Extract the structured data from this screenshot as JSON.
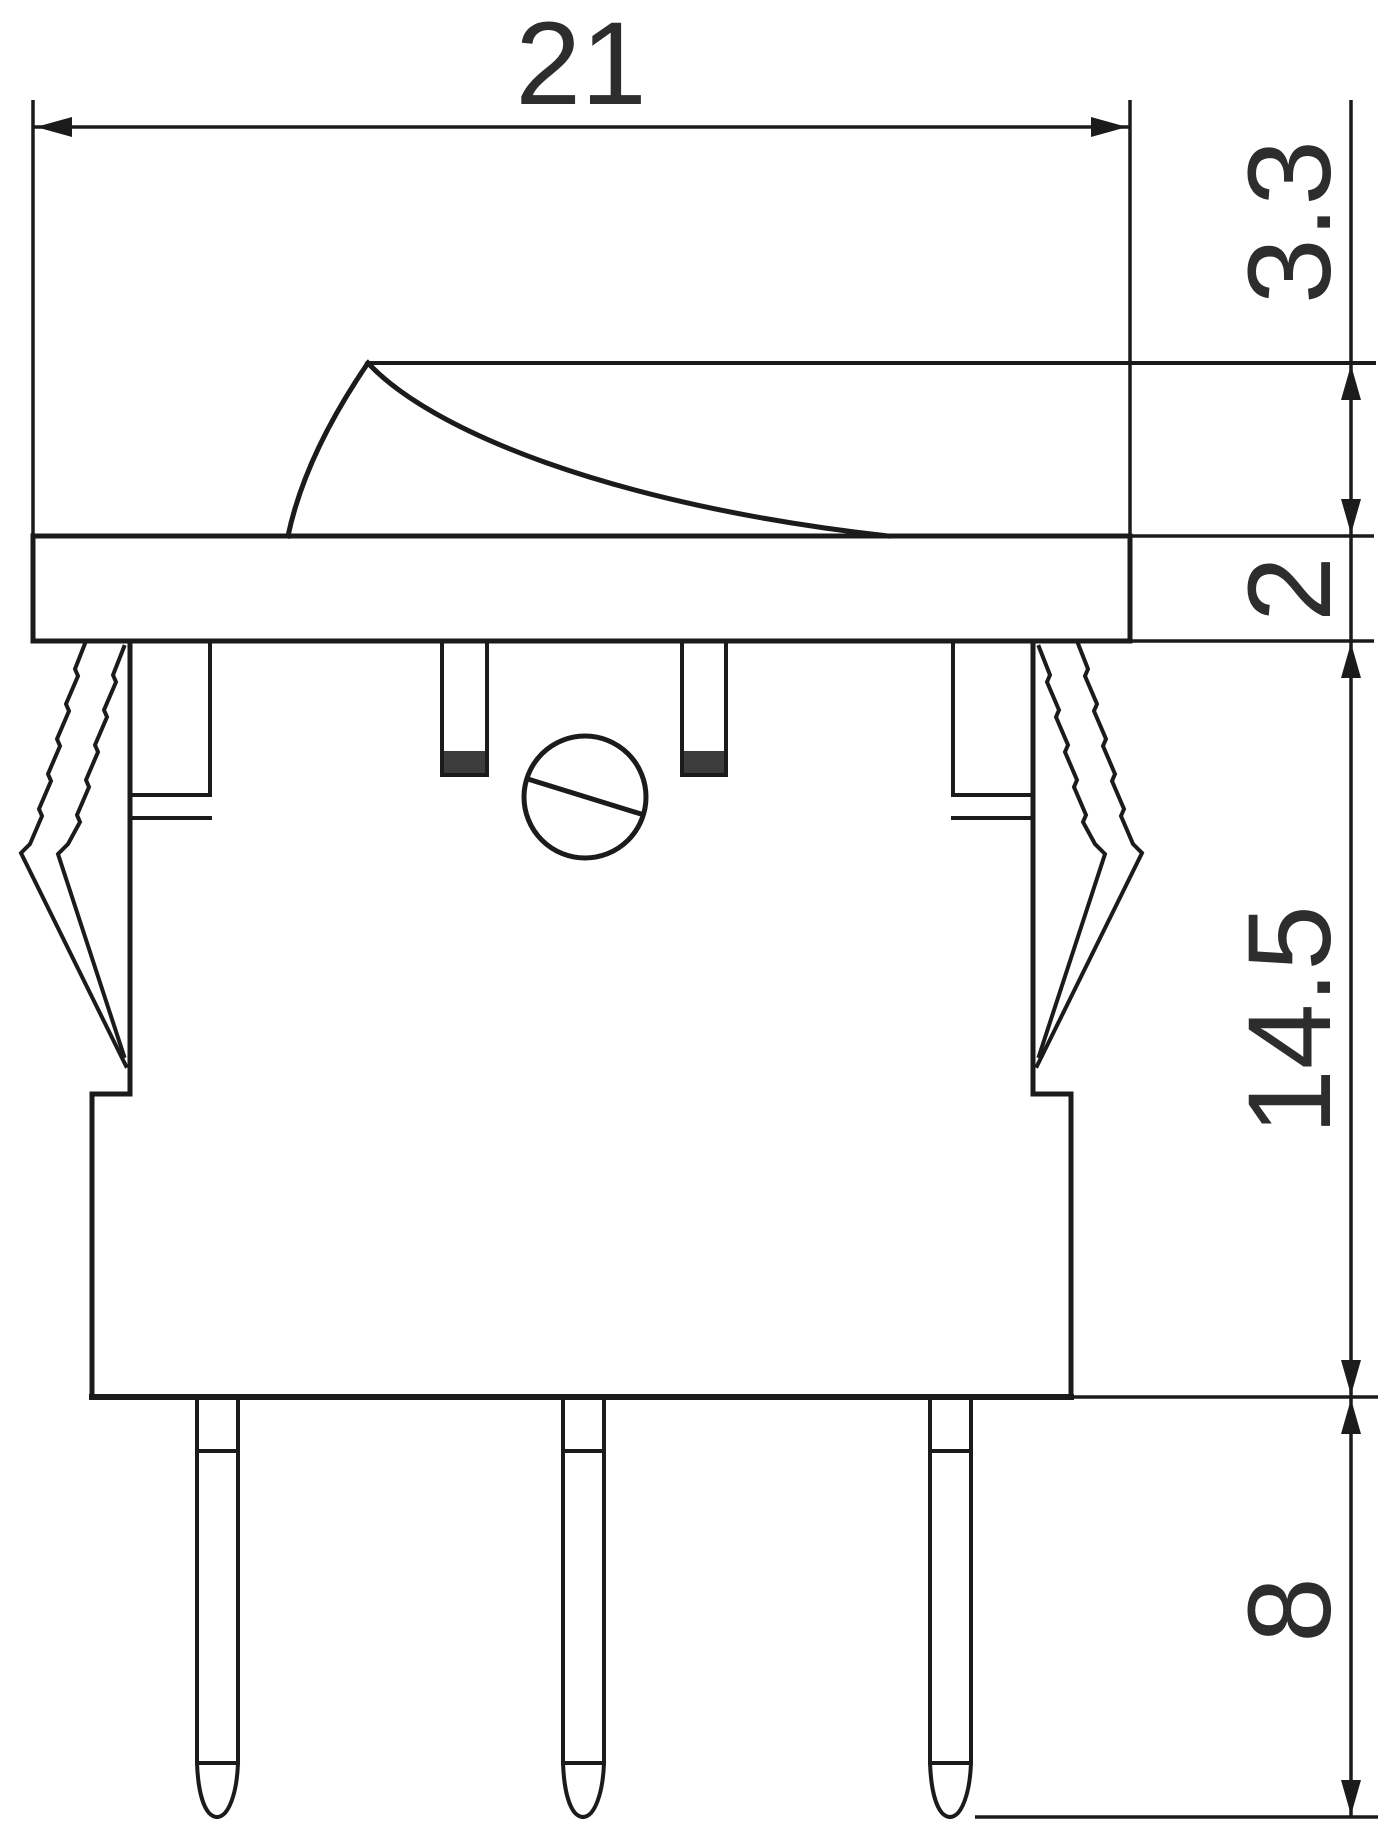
{
  "figure": {
    "description": "Technical dimension drawing of a snap-in rocker switch, side view",
    "type": "engineering-drawing"
  },
  "colors": {
    "line": "#1b1b1b",
    "text": "#2d2d2d",
    "background": "#ffffff",
    "post_cap_fill": "#3c3c3c"
  },
  "dimensions": {
    "overall_width": {
      "value": "21",
      "orientation": "horizontal",
      "measures": "overall bezel width"
    },
    "actuator_height": {
      "value": "3.3",
      "orientation": "vertical",
      "measures": "rocker actuator height above bezel"
    },
    "bezel_thickness": {
      "value": "2",
      "orientation": "vertical",
      "measures": "bezel flange thickness"
    },
    "body_height": {
      "value": "14.5",
      "orientation": "vertical",
      "measures": "housing depth below bezel"
    },
    "terminal_length": {
      "value": "8",
      "orientation": "vertical",
      "measures": "terminal pin length"
    }
  }
}
